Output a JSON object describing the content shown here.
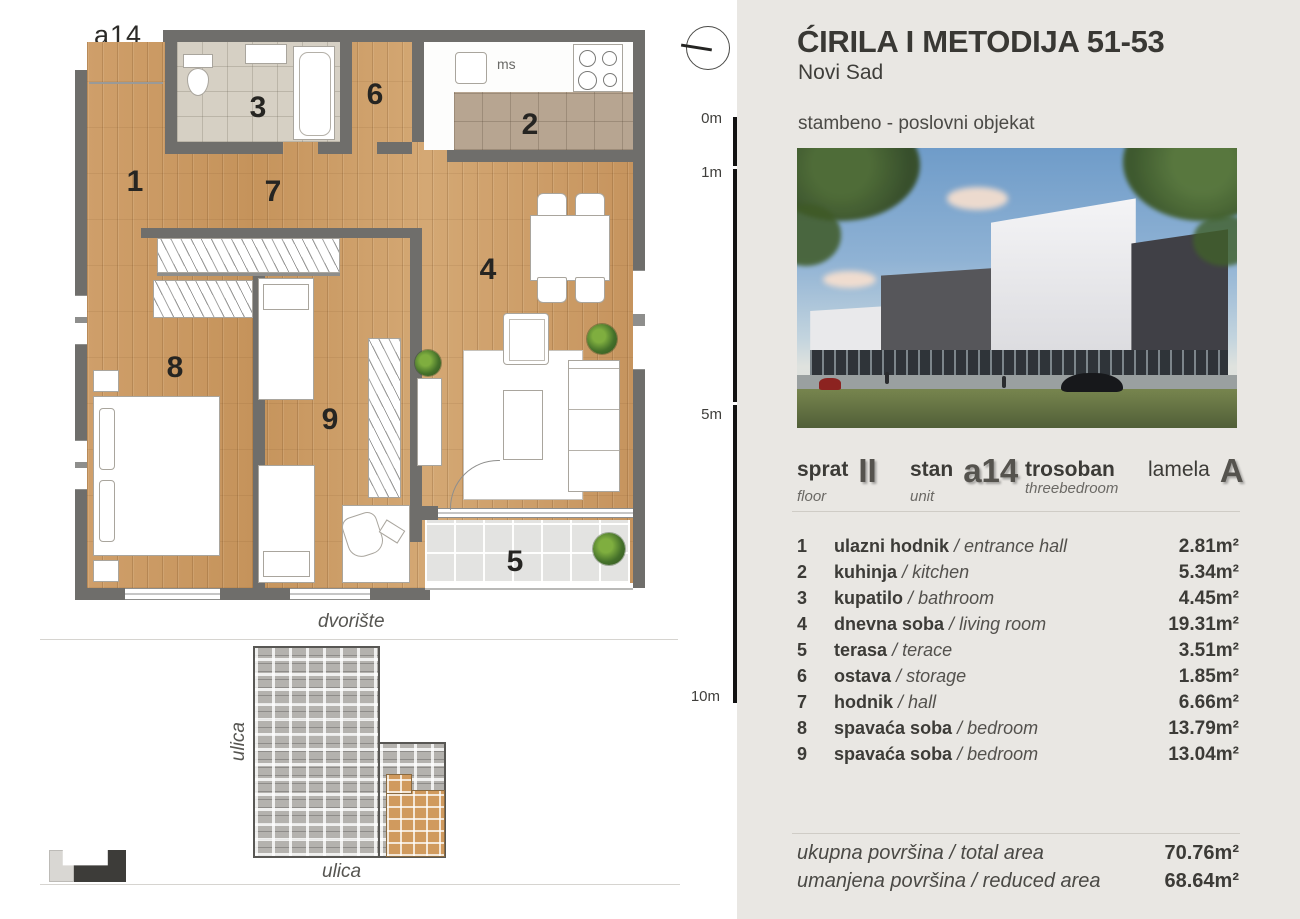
{
  "header": {
    "title": "ĆIRILA I METODIJA 51-53",
    "city": "Novi Sad",
    "building_type": "stambeno - poslovni objekat"
  },
  "scale_ticks": [
    "0m",
    "1m",
    "5m",
    "10m"
  ],
  "plan": {
    "unit_label": "a14",
    "room_numbers": [
      "1",
      "2",
      "3",
      "4",
      "5",
      "6",
      "7",
      "8",
      "9"
    ],
    "kitchen_note": "ms",
    "yard_label": "dvorište",
    "street_left": "ulica",
    "street_bottom": "ulica"
  },
  "unit_info": {
    "floor": {
      "label": "sprat",
      "value": "II",
      "sub": "floor"
    },
    "unit": {
      "label": "stan",
      "value": "a14",
      "sub": "unit"
    },
    "layout": {
      "label": "trosoban",
      "sub": "threebedroom"
    },
    "lamela": {
      "label": "lamela",
      "value": "A"
    }
  },
  "list_separator": "/",
  "rooms": [
    {
      "num": "1",
      "name": "ulazni hodnik",
      "name_en": "entrance hall",
      "area": "2.81m²"
    },
    {
      "num": "2",
      "name": "kuhinja",
      "name_en": "kitchen",
      "area": "5.34m²"
    },
    {
      "num": "3",
      "name": "kupatilo",
      "name_en": "bathroom",
      "area": "4.45m²"
    },
    {
      "num": "4",
      "name": "dnevna soba",
      "name_en": "living room",
      "area": "19.31m²"
    },
    {
      "num": "5",
      "name": "terasa",
      "name_en": "terace",
      "area": "3.51m²"
    },
    {
      "num": "6",
      "name": "ostava",
      "name_en": "storage",
      "area": "1.85m²"
    },
    {
      "num": "7",
      "name": "hodnik",
      "name_en": "hall",
      "area": "6.66m²"
    },
    {
      "num": "8",
      "name": "spavaća soba",
      "name_en": "bedroom",
      "area": "13.79m²"
    },
    {
      "num": "9",
      "name": "spavaća soba",
      "name_en": "bedroom",
      "area": "13.04m²"
    }
  ],
  "totals": [
    {
      "label": "ukupna površina / total area",
      "value": "70.76m²"
    },
    {
      "label": "umanjena površina / reduced area",
      "value": "68.64m²"
    }
  ],
  "colors": {
    "panel_bg": "#e9e7e3",
    "wall": "#6f6e6b",
    "wood": "#cb9c66",
    "highlighted_unit": "#d09a5e"
  }
}
